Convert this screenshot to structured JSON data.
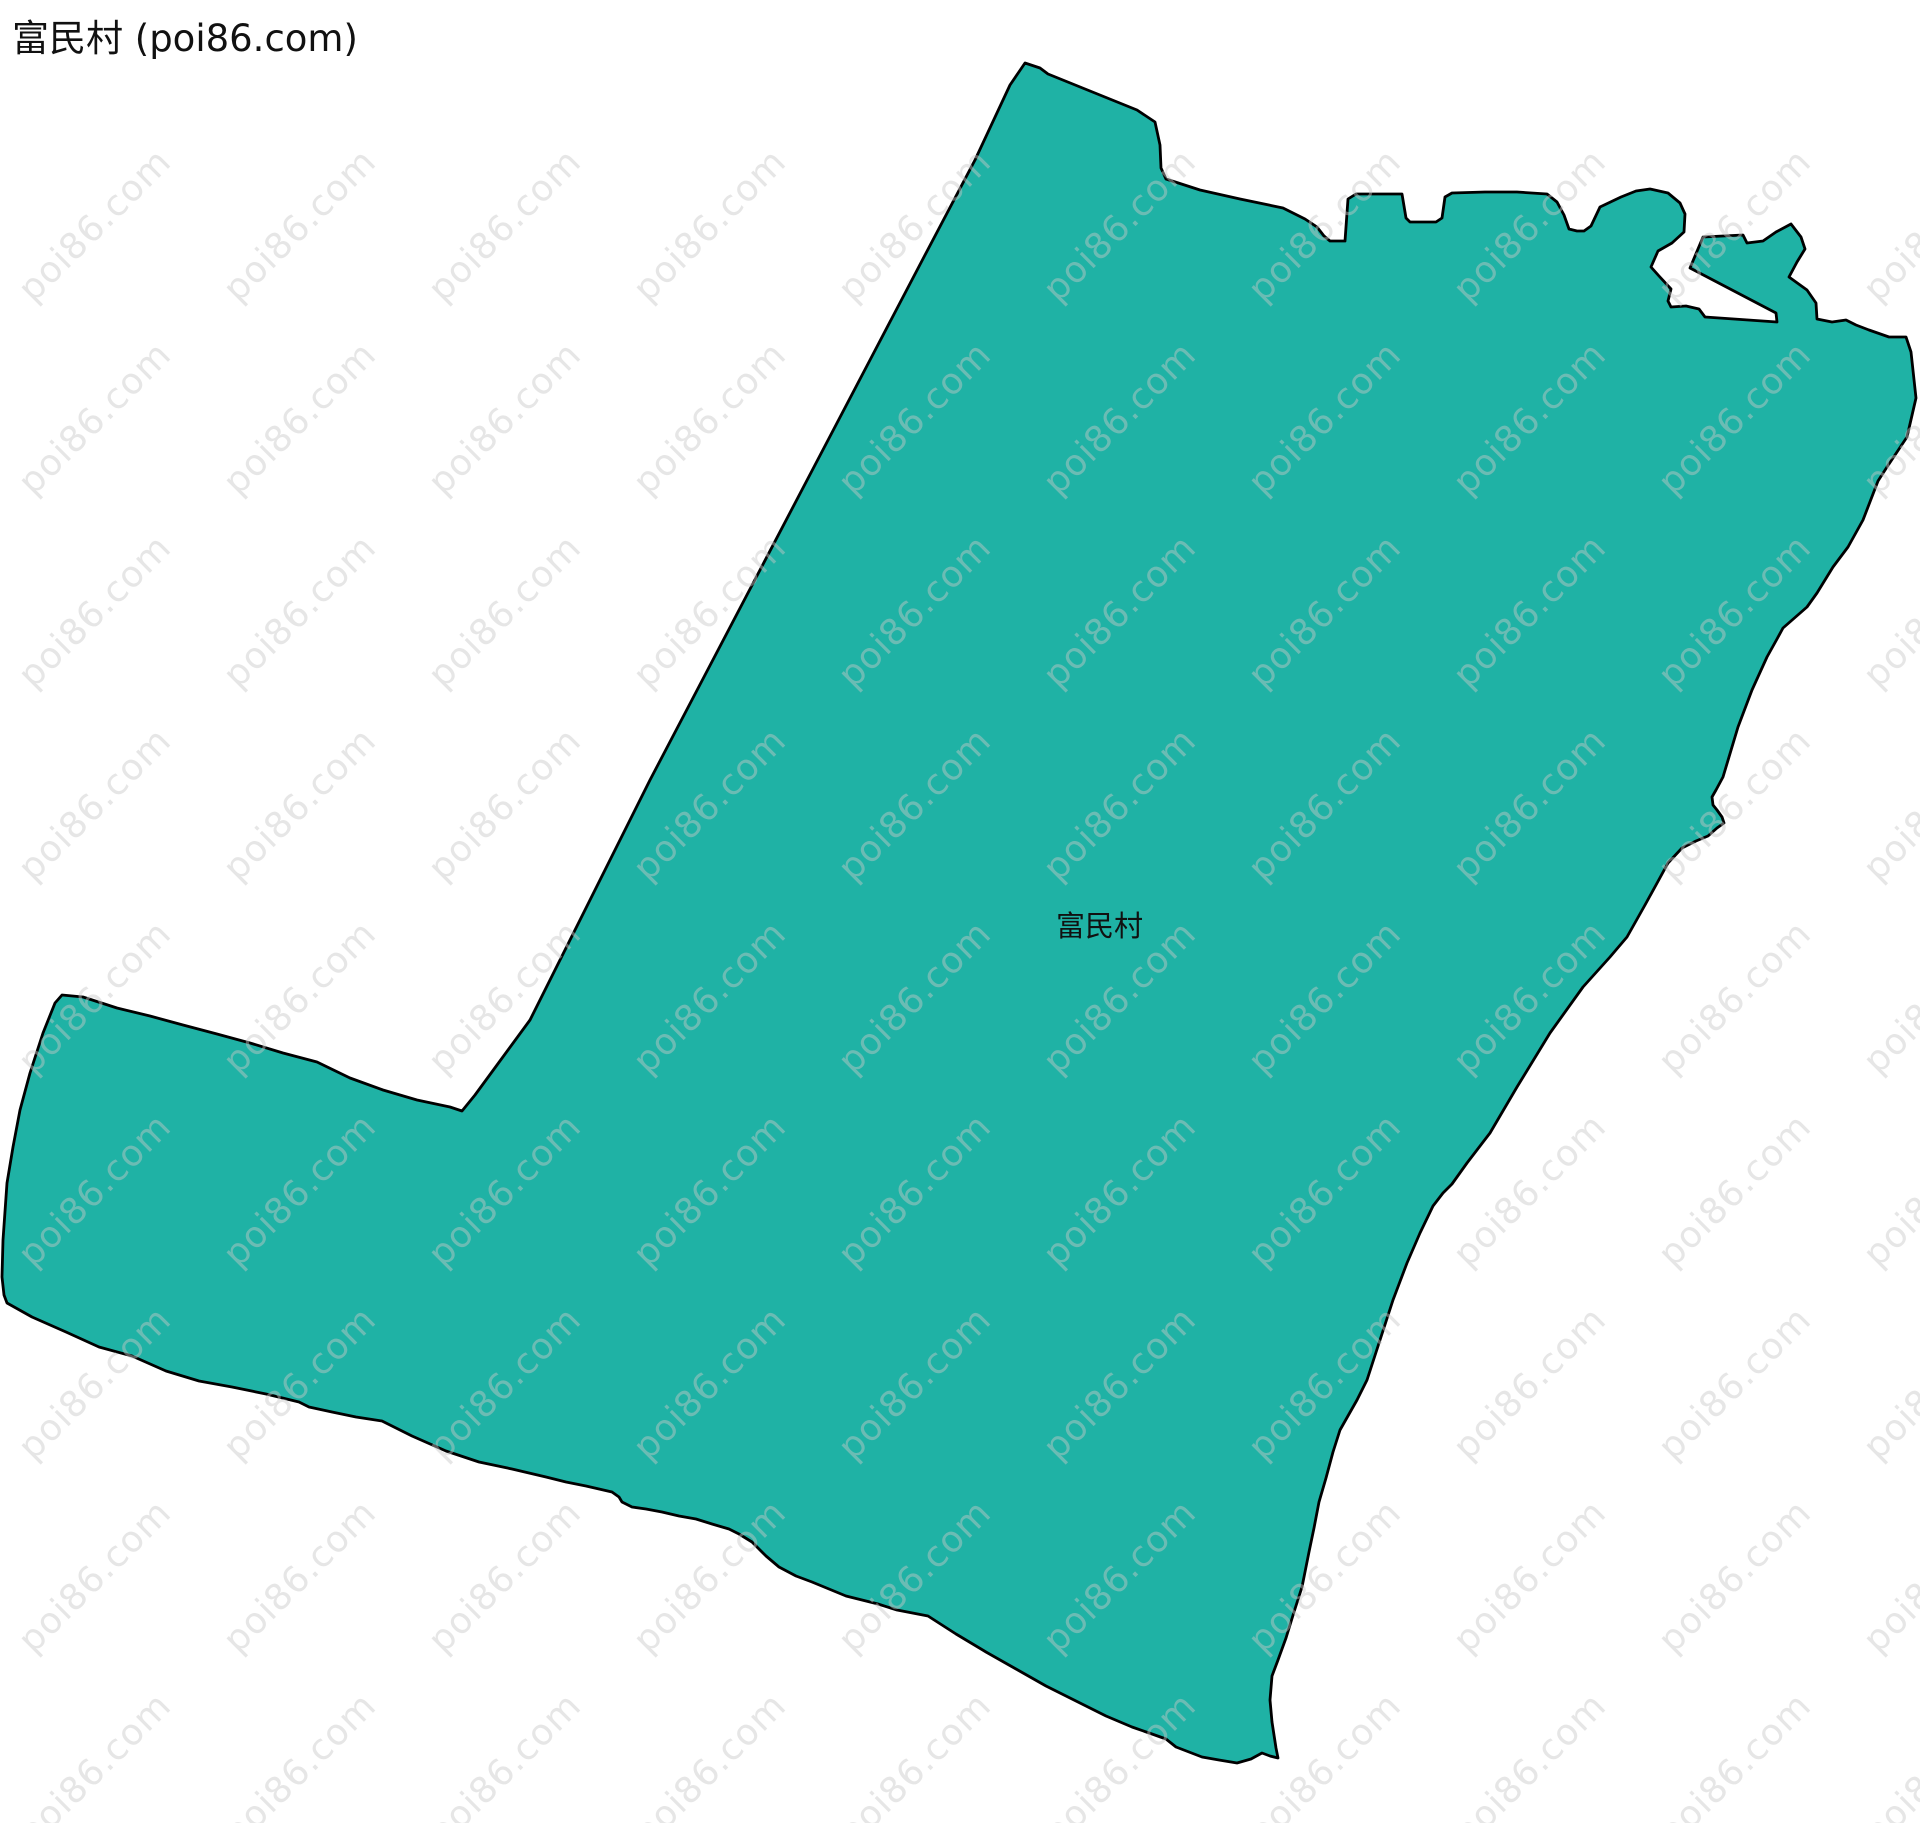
{
  "header": {
    "title": "富民村 (poi86.com)"
  },
  "map": {
    "region_label": "富民村",
    "fill_color": "#1FB2A5",
    "outline_color": "#000000",
    "outline_width": 2.8,
    "label_color": "#111111",
    "boundary_points": [
      [
        1025,
        63
      ],
      [
        1040,
        68
      ],
      [
        1048,
        74
      ],
      [
        1090,
        91
      ],
      [
        1137,
        110
      ],
      [
        1155,
        122
      ],
      [
        1160,
        145
      ],
      [
        1161,
        168
      ],
      [
        1166,
        179
      ],
      [
        1200,
        190
      ],
      [
        1240,
        199
      ],
      [
        1283,
        208
      ],
      [
        1305,
        219
      ],
      [
        1317,
        227
      ],
      [
        1324,
        236
      ],
      [
        1330,
        241
      ],
      [
        1345,
        241
      ],
      [
        1348,
        199
      ],
      [
        1356,
        194
      ],
      [
        1402,
        194
      ],
      [
        1406,
        218
      ],
      [
        1410,
        222
      ],
      [
        1436,
        222
      ],
      [
        1442,
        218
      ],
      [
        1445,
        197
      ],
      [
        1452,
        193
      ],
      [
        1485,
        192
      ],
      [
        1517,
        192
      ],
      [
        1547,
        194
      ],
      [
        1557,
        202
      ],
      [
        1564,
        215
      ],
      [
        1569,
        229
      ],
      [
        1577,
        231
      ],
      [
        1584,
        231
      ],
      [
        1591,
        226
      ],
      [
        1600,
        207
      ],
      [
        1621,
        197
      ],
      [
        1636,
        191
      ],
      [
        1650,
        189
      ],
      [
        1668,
        193
      ],
      [
        1680,
        203
      ],
      [
        1685,
        214
      ],
      [
        1684,
        232
      ],
      [
        1672,
        243
      ],
      [
        1658,
        251
      ],
      [
        1651,
        267
      ],
      [
        1659,
        276
      ],
      [
        1671,
        289
      ],
      [
        1668,
        301
      ],
      [
        1671,
        307
      ],
      [
        1686,
        306
      ],
      [
        1699,
        309
      ],
      [
        1705,
        317
      ],
      [
        1777,
        322
      ],
      [
        1776,
        313
      ],
      [
        1690,
        268
      ],
      [
        1703,
        237
      ],
      [
        1743,
        235
      ],
      [
        1747,
        243
      ],
      [
        1763,
        241
      ],
      [
        1776,
        232
      ],
      [
        1791,
        224
      ],
      [
        1801,
        237
      ],
      [
        1805,
        249
      ],
      [
        1797,
        262
      ],
      [
        1789,
        277
      ],
      [
        1807,
        290
      ],
      [
        1816,
        303
      ],
      [
        1817,
        319
      ],
      [
        1832,
        322
      ],
      [
        1846,
        320
      ],
      [
        1856,
        325
      ],
      [
        1869,
        330
      ],
      [
        1889,
        337
      ],
      [
        1906,
        337
      ],
      [
        1911,
        352
      ],
      [
        1916,
        398
      ],
      [
        1907,
        437
      ],
      [
        1887,
        467
      ],
      [
        1878,
        481
      ],
      [
        1863,
        520
      ],
      [
        1848,
        547
      ],
      [
        1833,
        567
      ],
      [
        1817,
        593
      ],
      [
        1807,
        607
      ],
      [
        1783,
        628
      ],
      [
        1777,
        639
      ],
      [
        1767,
        657
      ],
      [
        1752,
        690
      ],
      [
        1738,
        727
      ],
      [
        1723,
        777
      ],
      [
        1716,
        790
      ],
      [
        1712,
        797
      ],
      [
        1713,
        805
      ],
      [
        1717,
        810
      ],
      [
        1722,
        817
      ],
      [
        1724,
        823
      ],
      [
        1717,
        828
      ],
      [
        1708,
        836
      ],
      [
        1696,
        841
      ],
      [
        1682,
        848
      ],
      [
        1668,
        863
      ],
      [
        1656,
        885
      ],
      [
        1645,
        905
      ],
      [
        1627,
        937
      ],
      [
        1610,
        957
      ],
      [
        1583,
        987
      ],
      [
        1550,
        1033
      ],
      [
        1517,
        1087
      ],
      [
        1490,
        1133
      ],
      [
        1467,
        1163
      ],
      [
        1452,
        1184
      ],
      [
        1443,
        1193
      ],
      [
        1433,
        1206
      ],
      [
        1420,
        1233
      ],
      [
        1407,
        1263
      ],
      [
        1393,
        1300
      ],
      [
        1380,
        1340
      ],
      [
        1367,
        1380
      ],
      [
        1357,
        1400
      ],
      [
        1340,
        1430
      ],
      [
        1333,
        1452
      ],
      [
        1326,
        1478
      ],
      [
        1319,
        1502
      ],
      [
        1314,
        1528
      ],
      [
        1309,
        1552
      ],
      [
        1302,
        1587
      ],
      [
        1294,
        1612
      ],
      [
        1286,
        1638
      ],
      [
        1278,
        1660
      ],
      [
        1272,
        1676
      ],
      [
        1270,
        1700
      ],
      [
        1272,
        1722
      ],
      [
        1276,
        1748
      ],
      [
        1278,
        1758
      ],
      [
        1270,
        1756
      ],
      [
        1262,
        1753
      ],
      [
        1251,
        1759
      ],
      [
        1237,
        1763
      ],
      [
        1219,
        1760
      ],
      [
        1202,
        1757
      ],
      [
        1189,
        1752
      ],
      [
        1176,
        1747
      ],
      [
        1166,
        1739
      ],
      [
        1152,
        1734
      ],
      [
        1132,
        1727
      ],
      [
        1106,
        1716
      ],
      [
        1076,
        1701
      ],
      [
        1046,
        1686
      ],
      [
        1016,
        1669
      ],
      [
        986,
        1652
      ],
      [
        956,
        1634
      ],
      [
        928,
        1616
      ],
      [
        897,
        1610
      ],
      [
        878,
        1604
      ],
      [
        846,
        1596
      ],
      [
        812,
        1582
      ],
      [
        796,
        1576
      ],
      [
        779,
        1567
      ],
      [
        766,
        1556
      ],
      [
        752,
        1542
      ],
      [
        739,
        1534
      ],
      [
        729,
        1529
      ],
      [
        712,
        1524
      ],
      [
        696,
        1519
      ],
      [
        679,
        1516
      ],
      [
        662,
        1512
      ],
      [
        646,
        1509
      ],
      [
        632,
        1507
      ],
      [
        622,
        1502
      ],
      [
        619,
        1497
      ],
      [
        612,
        1492
      ],
      [
        586,
        1486
      ],
      [
        566,
        1482
      ],
      [
        546,
        1477
      ],
      [
        512,
        1469
      ],
      [
        479,
        1462
      ],
      [
        446,
        1451
      ],
      [
        412,
        1436
      ],
      [
        382,
        1421
      ],
      [
        369,
        1419
      ],
      [
        356,
        1417
      ],
      [
        332,
        1412
      ],
      [
        309,
        1407
      ],
      [
        299,
        1402
      ],
      [
        266,
        1394
      ],
      [
        232,
        1387
      ],
      [
        199,
        1381
      ],
      [
        166,
        1371
      ],
      [
        132,
        1356
      ],
      [
        99,
        1347
      ],
      [
        66,
        1332
      ],
      [
        32,
        1317
      ],
      [
        7,
        1303
      ],
      [
        4,
        1295
      ],
      [
        2,
        1277
      ],
      [
        3,
        1240
      ],
      [
        7,
        1183
      ],
      [
        13,
        1147
      ],
      [
        20,
        1110
      ],
      [
        30,
        1073
      ],
      [
        43,
        1033
      ],
      [
        55,
        1003
      ],
      [
        62,
        995
      ],
      [
        83,
        997
      ],
      [
        117,
        1008
      ],
      [
        150,
        1016
      ],
      [
        183,
        1025
      ],
      [
        217,
        1034
      ],
      [
        250,
        1043
      ],
      [
        283,
        1053
      ],
      [
        317,
        1062
      ],
      [
        350,
        1078
      ],
      [
        383,
        1090
      ],
      [
        417,
        1100
      ],
      [
        450,
        1107
      ],
      [
        462,
        1111
      ],
      [
        475,
        1095
      ],
      [
        497,
        1065
      ],
      [
        530,
        1020
      ],
      [
        565,
        950
      ],
      [
        605,
        870
      ],
      [
        650,
        780
      ],
      [
        705,
        675
      ],
      [
        760,
        570
      ],
      [
        815,
        465
      ],
      [
        870,
        360
      ],
      [
        925,
        255
      ],
      [
        975,
        160
      ],
      [
        1010,
        85
      ]
    ]
  },
  "watermark": {
    "text": "poi86.com",
    "color": "rgba(200,200,200,0.45)"
  }
}
